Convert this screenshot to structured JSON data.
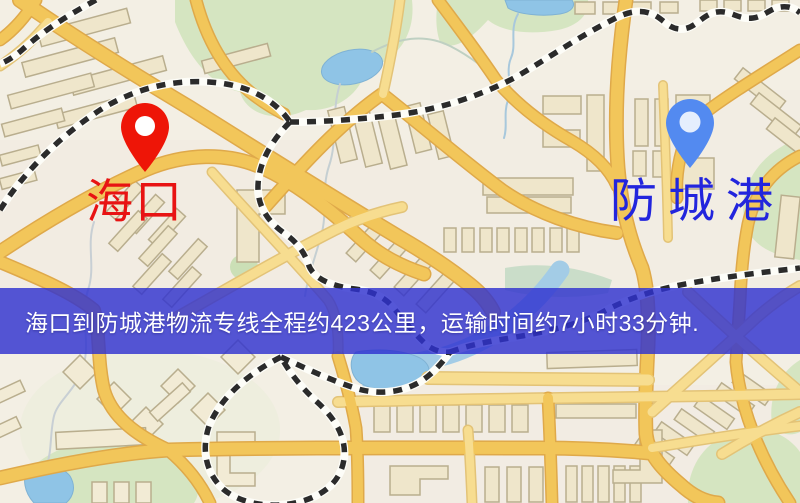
{
  "banner": {
    "text": "海口到防城港物流专线全程约423公里，运输时间约7小时33分钟."
  },
  "route": {
    "distance_text": "423公里",
    "duration_text": "7小时33分钟"
  },
  "origin": {
    "label": "海口"
  },
  "destination": {
    "label": "防城港"
  },
  "icons": {
    "origin_pin": "map-pin",
    "destination_pin": "map-pin"
  },
  "palette": {
    "banner-bg": "rgba(48,50,208,0.82)",
    "banner-text": "#ffffff",
    "origin-pin": "#ee1507",
    "origin-label": "#e81313",
    "destination-pin": "#538af0",
    "destination-label": "#2225dd",
    "map-bg": "#f3efe4",
    "park": "#d5e5c1",
    "water": "#8fc4e6",
    "road-major": "#f2c65a",
    "road-minor": "#f7dd90",
    "building": "#efe6cb",
    "rail-dark": "#2b2b2b"
  }
}
